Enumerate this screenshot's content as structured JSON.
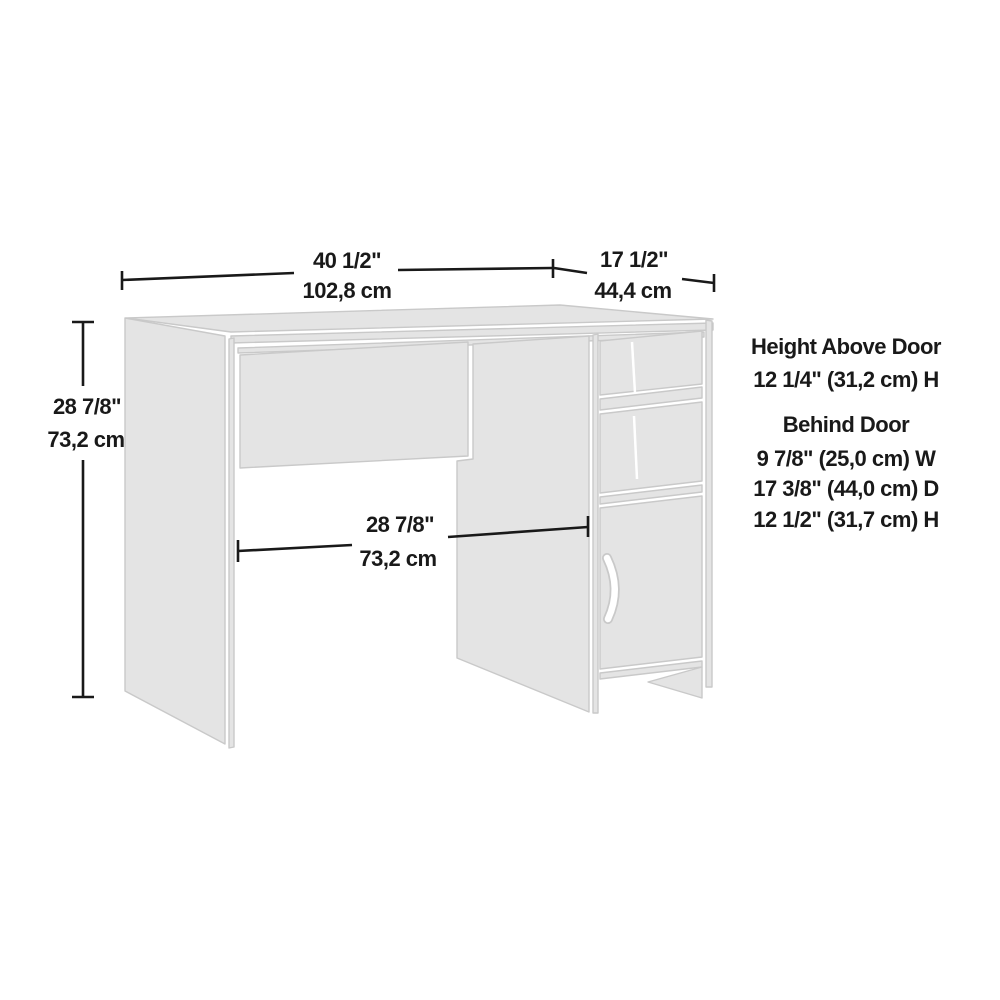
{
  "diagram": {
    "subject": "desk-dimension-drawing"
  },
  "colors": {
    "background": "#ffffff",
    "panel_fill": "#e4e4e4",
    "panel_stroke": "#c9c9c9",
    "dimension_ink": "#191919"
  },
  "dimensions": {
    "width": {
      "inches": "40 1/2\"",
      "metric": "102,8 cm"
    },
    "depth": {
      "inches": "17 1/2\"",
      "metric": "44,4 cm"
    },
    "height": {
      "inches": "28 7/8\"",
      "metric": "73,2 cm"
    },
    "knee_space": {
      "inches": "28 7/8\"",
      "metric": "73,2 cm"
    }
  },
  "notes": {
    "above_door": {
      "title": "Height Above Door",
      "value": "12 1/4\" (31,2 cm) H"
    },
    "behind_door": {
      "title": "Behind Door",
      "width": "9 7/8\" (25,0 cm) W",
      "depth": "17 3/8\" (44,0 cm) D",
      "height": "12 1/2\" (31,7 cm) H"
    }
  }
}
